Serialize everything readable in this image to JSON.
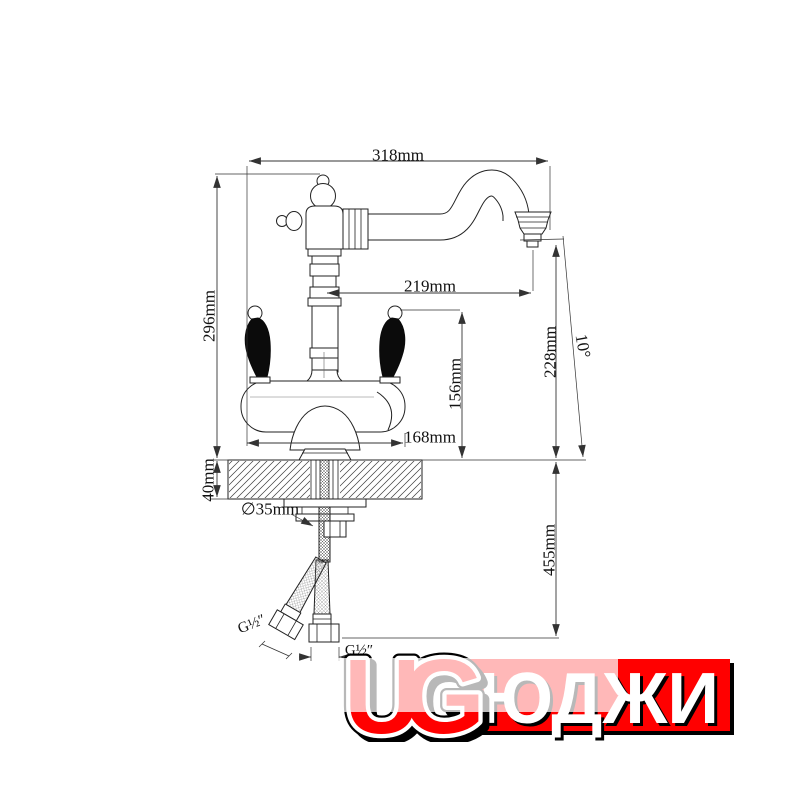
{
  "drawing": {
    "dim_width_total": "318mm",
    "dim_height_above_counter": "296mm",
    "dim_spout_reach": "219mm",
    "dim_spout_height": "228mm",
    "dim_tilt_angle": "10°",
    "dim_handle_height": "156mm",
    "dim_body_width": "168mm",
    "dim_counter_thickness": "40mm",
    "dim_hole_diameter": "∅35mm",
    "dim_hose_drop": "455mm",
    "thread_left_hose": "G½″",
    "thread_bottom_hose": "G½″",
    "line_color": "#2a2a2a"
  },
  "logo": {
    "latin": "UG",
    "cyrillic": "ЮДЖИ",
    "red": "#ff0000",
    "black": "#000000",
    "white": "#ffffff"
  }
}
